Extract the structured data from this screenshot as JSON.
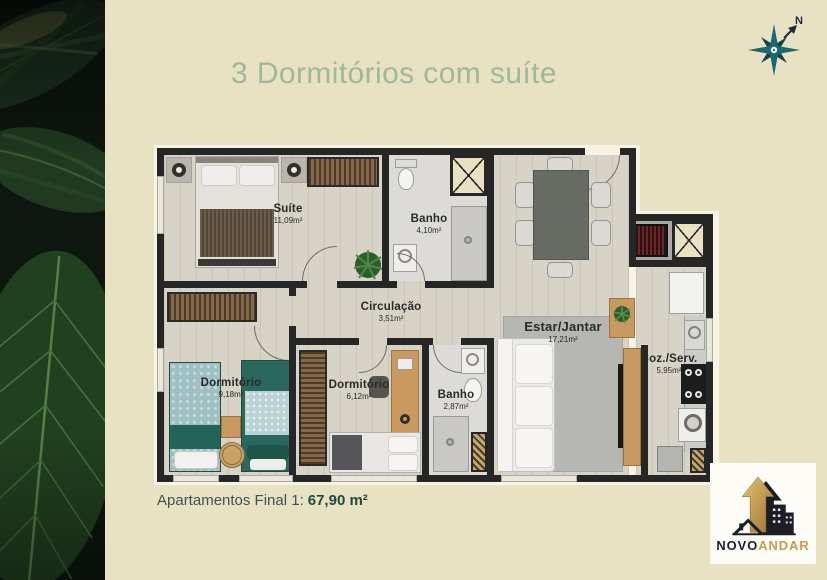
{
  "page": {
    "title": "3 Dormitórios com suíte"
  },
  "compass": {
    "north_label": "N"
  },
  "floor_plan": {
    "rooms": [
      {
        "id": "suite",
        "name": "Suíte",
        "area": "11,09m²"
      },
      {
        "id": "banho-suite",
        "name": "Banho",
        "area": "4,10m²"
      },
      {
        "id": "circulacao",
        "name": "Circulação",
        "area": "3,51m²"
      },
      {
        "id": "dormitorio-1",
        "name": "Dormitório",
        "area": "9,18m²"
      },
      {
        "id": "dormitorio-2",
        "name": "Dormitório",
        "area": "6,12m²"
      },
      {
        "id": "banho-social",
        "name": "Banho",
        "area": "2,87m²"
      },
      {
        "id": "estar-jantar",
        "name": "Estar/Jantar",
        "area": "17,21m²"
      },
      {
        "id": "cozinha-servico",
        "name": "Coz./Serv.",
        "area": "5,95m²"
      }
    ]
  },
  "footer": {
    "label": "Apartamentos Final 1:",
    "value": "67,90 m²"
  },
  "logo": {
    "primary": "NOVO",
    "secondary": "ANDAR"
  },
  "colors": {
    "background": "#e9e2c2",
    "title": "#9fb79d",
    "accent_teal": "#186a70",
    "wall": "#262626",
    "footer_text": "#1e4a44",
    "logo_gold": "#c49a52"
  }
}
